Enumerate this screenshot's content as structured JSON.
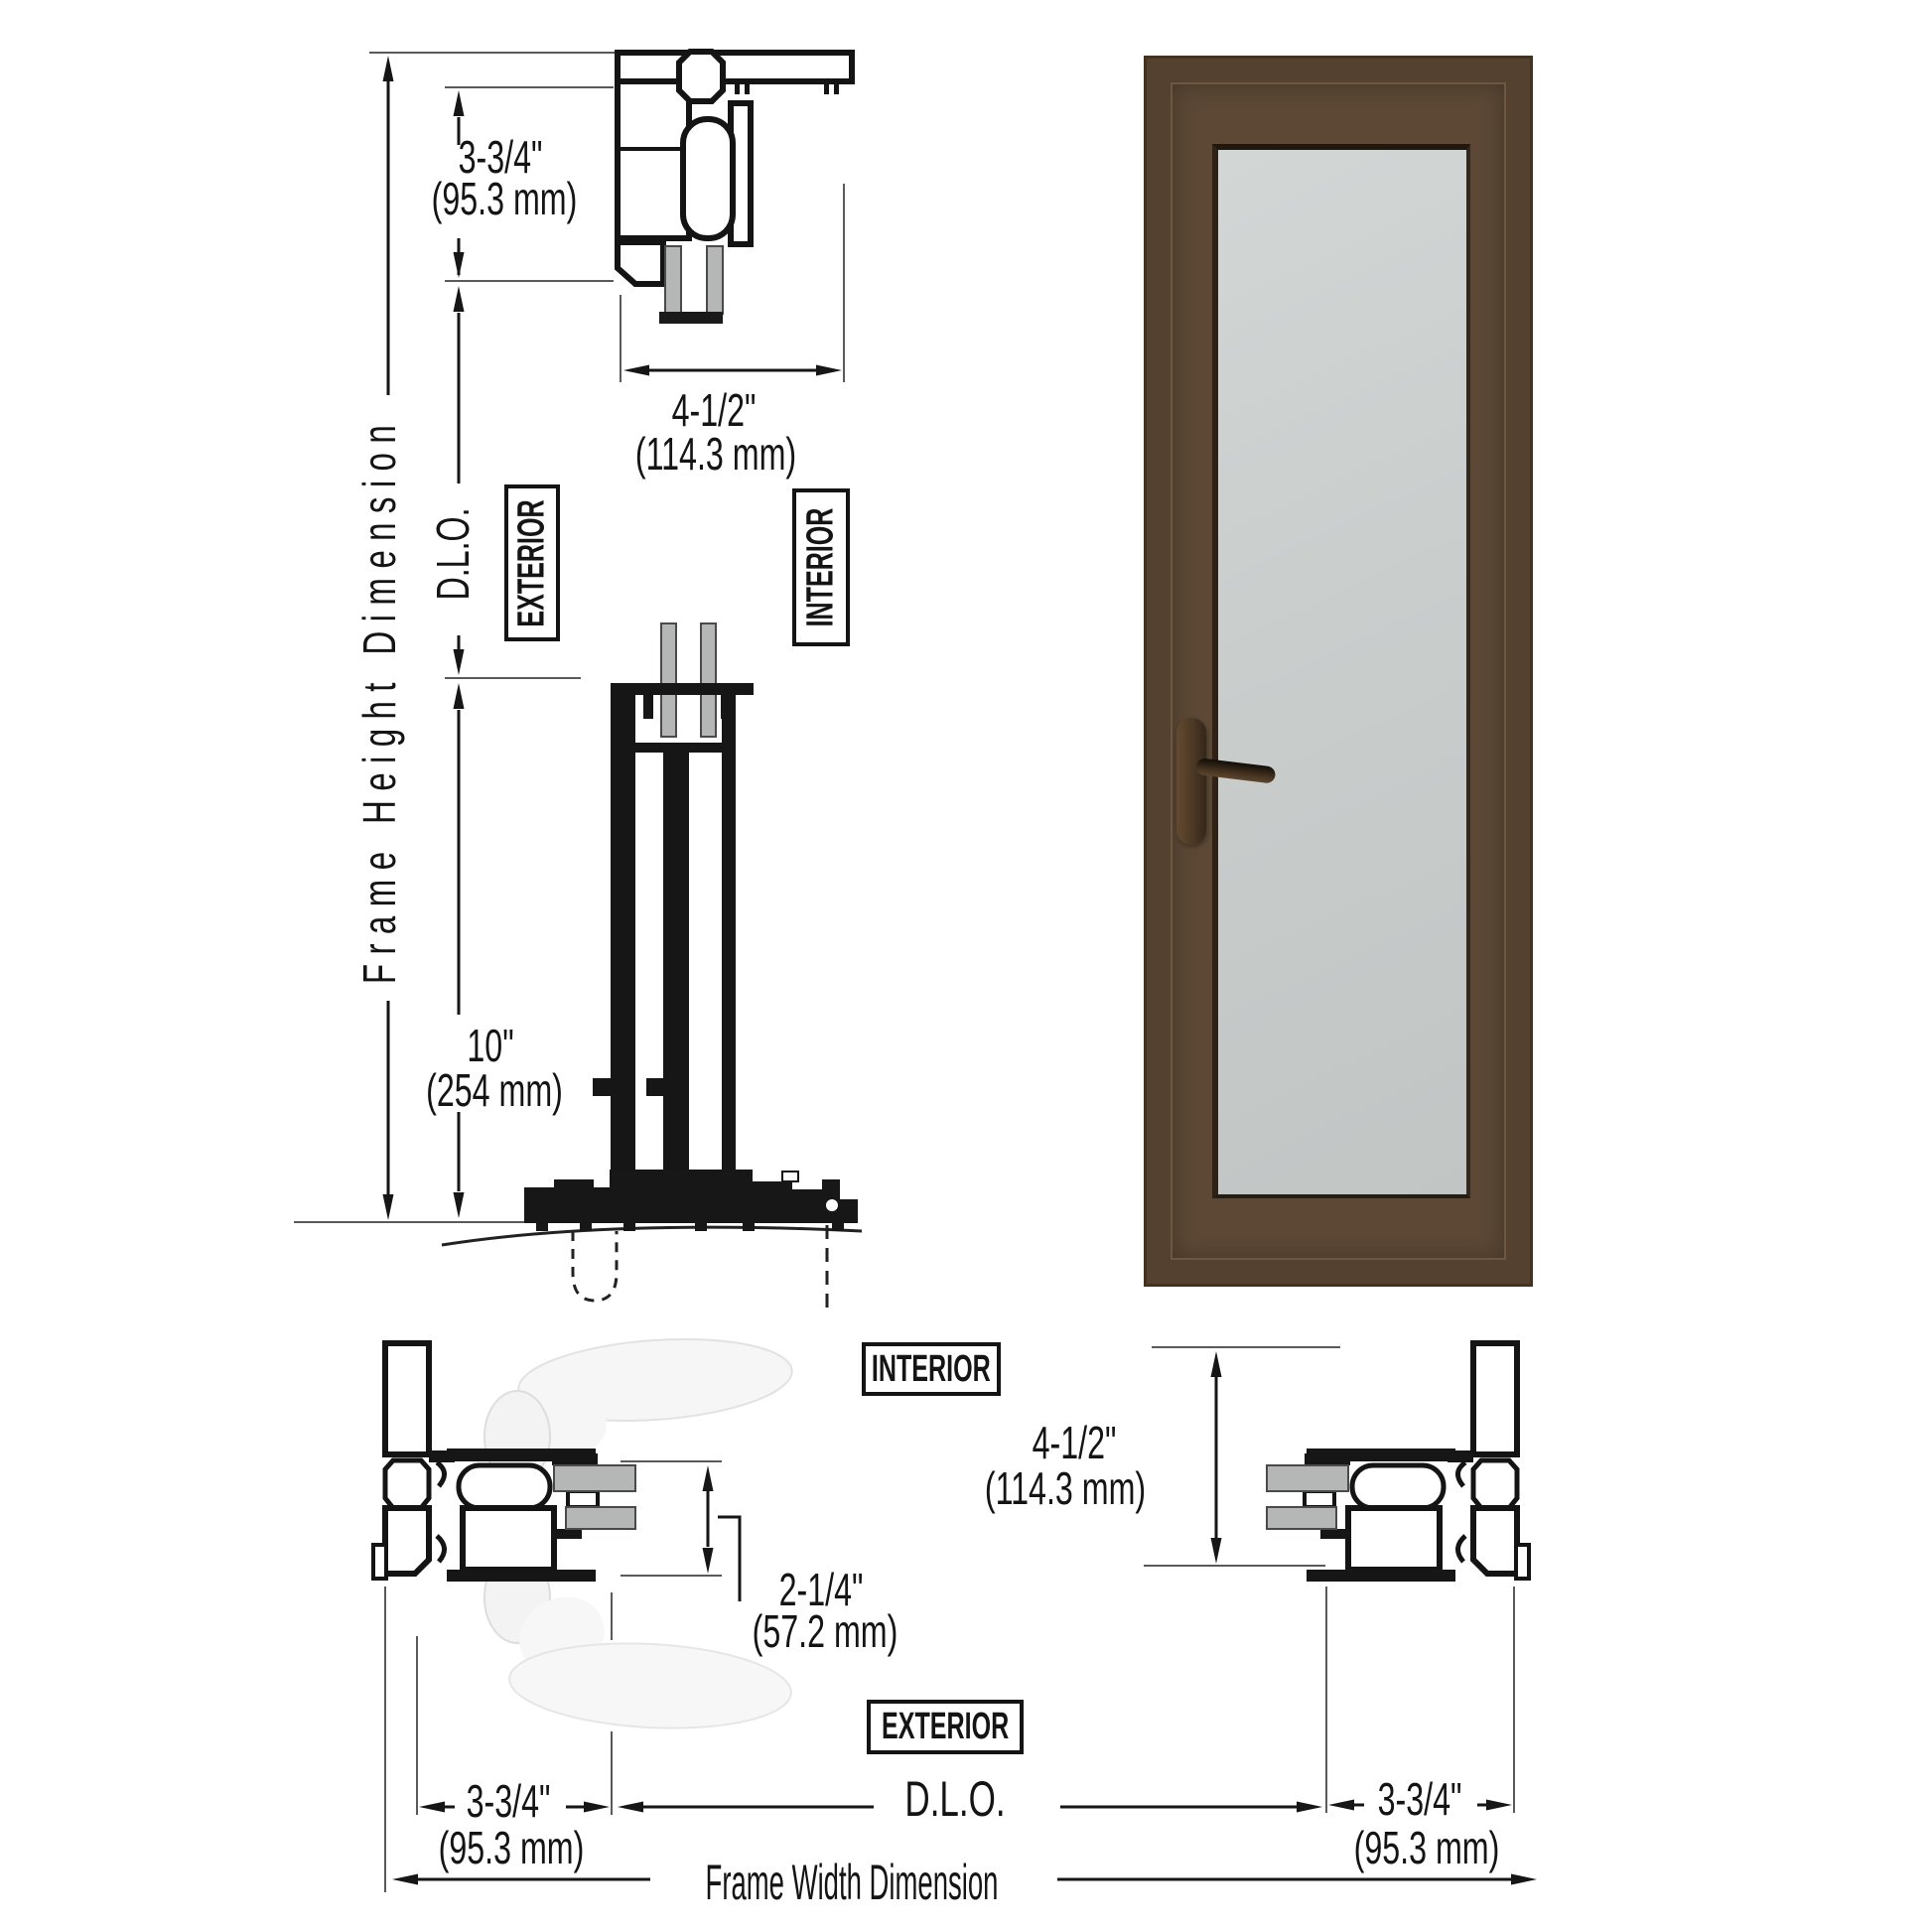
{
  "labels": {
    "frame_height_dimension": "Frame Height Dimension",
    "frame_width_dimension": "Frame Width Dimension",
    "dlo_vertical": "D.L.O.",
    "dlo_horizontal": "D.L.O.",
    "exterior_top": "EXTERIOR",
    "interior_top": "INTERIOR",
    "interior_bottom": "INTERIOR",
    "exterior_bottom": "EXTERIOR"
  },
  "dimensions": {
    "head_height_in": "3-3/4\"",
    "head_height_mm": "(95.3 mm)",
    "frame_depth_top_in": "4-1/2\"",
    "frame_depth_top_mm": "(114.3 mm)",
    "bottom_rail_in": "10\"",
    "bottom_rail_mm": "(254 mm)",
    "lock_stile_in": "2-1/4\"",
    "lock_stile_mm": "(57.2 mm)",
    "frame_depth_right_in": "4-1/2\"",
    "frame_depth_right_mm": "(114.3 mm)",
    "left_jamb_in": "3-3/4\"",
    "left_jamb_mm": "(95.3 mm)",
    "right_jamb_in": "3-3/4\"",
    "right_jamb_mm": "(95.3 mm)"
  }
}
